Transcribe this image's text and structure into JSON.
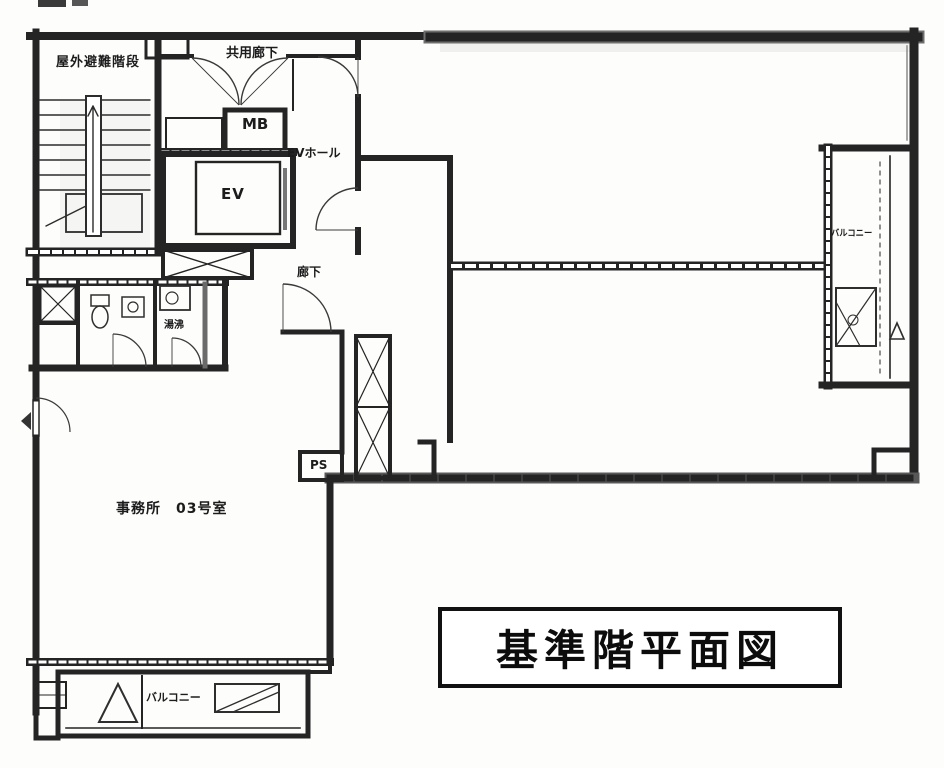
{
  "meta": {
    "document_type": "scanned architectural floor plan",
    "paper_color": "#fdfdfc",
    "ink_color": "#1e1e1e",
    "wall_shade_color": "#6e6e6e"
  },
  "title": {
    "text": "基準階平面図"
  },
  "labels": {
    "stairs": "屋外避難階段",
    "corridor_top": "共用廊下",
    "meter_box": "MB",
    "elevator": "EV",
    "elevator_hall": "EVホール",
    "corridor": "廊下",
    "kitchenette": "湯沸",
    "pipe_space": "PS",
    "office": "事務所　03号室",
    "balcony_bottom": "バルコニー",
    "balcony_right": "バルコニー"
  },
  "rooms": [
    {
      "name": "outdoor-evacuation-stairs",
      "label": "屋外避難階段"
    },
    {
      "name": "common-corridor",
      "label": "共用廊下"
    },
    {
      "name": "meter-box",
      "label": "MB"
    },
    {
      "name": "elevator",
      "label": "EV"
    },
    {
      "name": "elevator-hall",
      "label": "EVホール"
    },
    {
      "name": "corridor",
      "label": "廊下"
    },
    {
      "name": "kitchenette",
      "label": "湯沸"
    },
    {
      "name": "pipe-space",
      "label": "PS"
    },
    {
      "name": "office-unit-03",
      "label": "事務所　03号室"
    },
    {
      "name": "balcony-south",
      "label": "バルコニー"
    },
    {
      "name": "balcony-east",
      "label": "バルコニー"
    }
  ]
}
